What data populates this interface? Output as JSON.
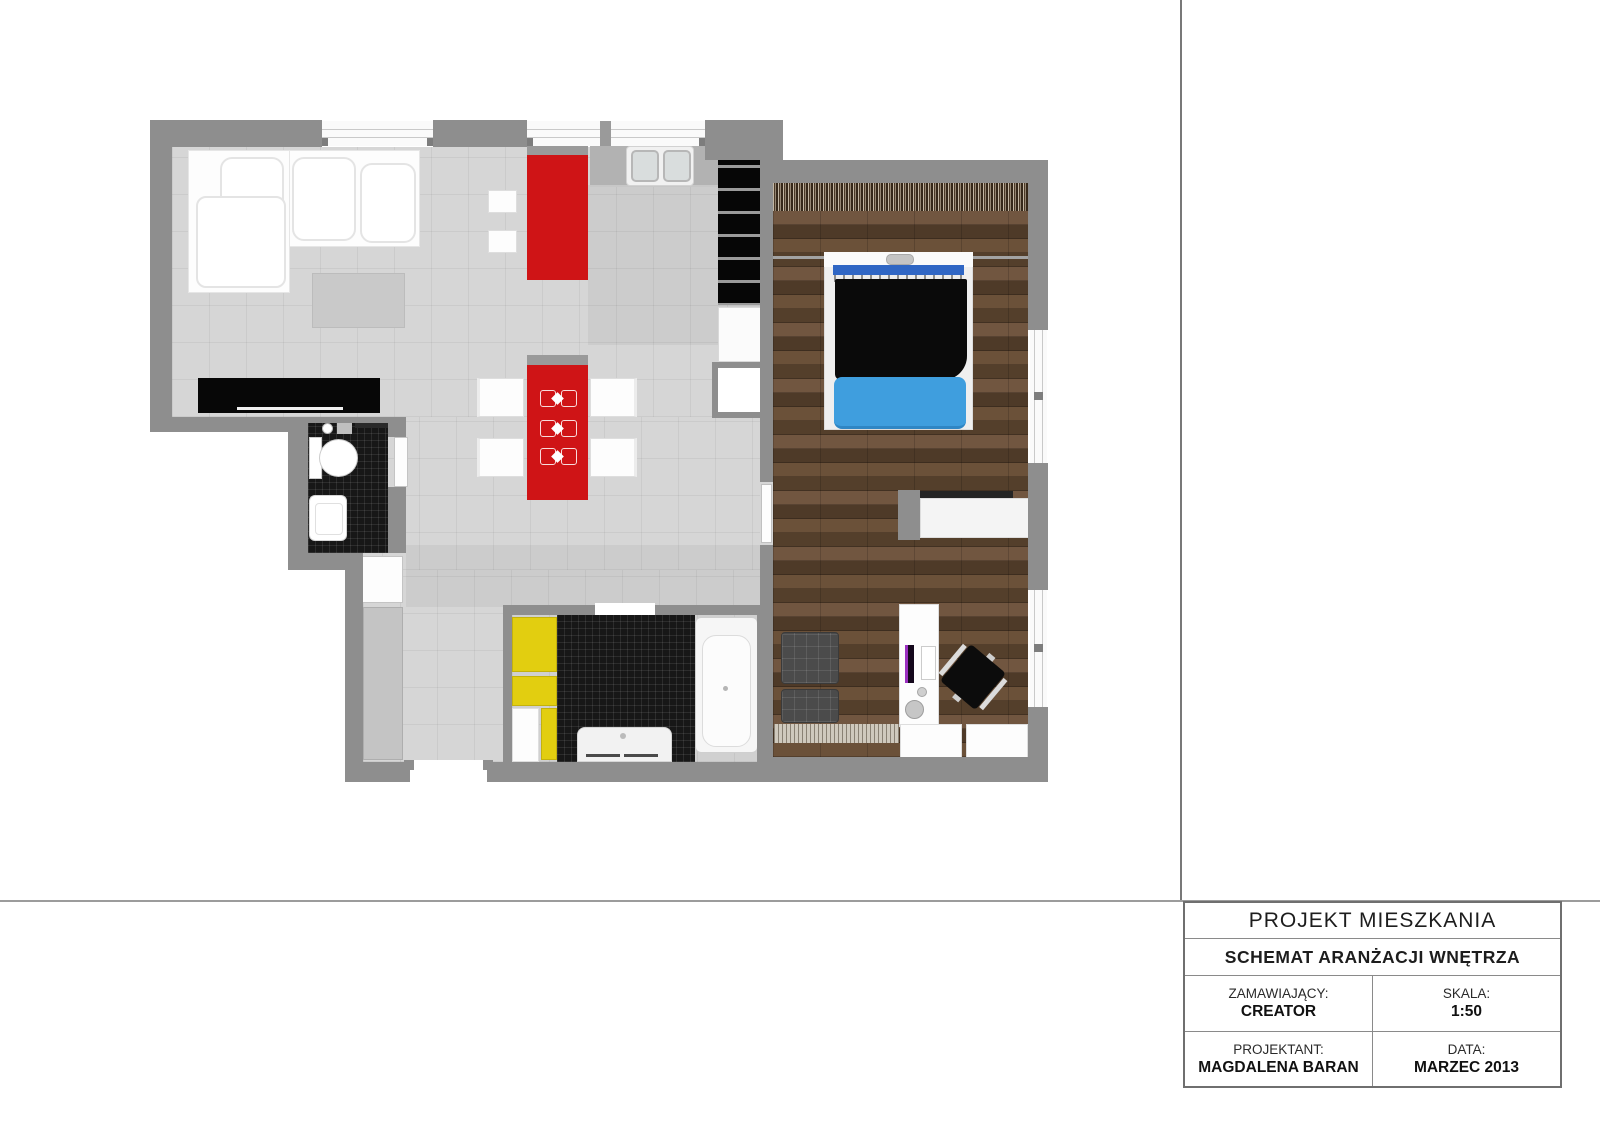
{
  "title_block": {
    "title": "PROJEKT MIESZKANIA",
    "subtitle": "SCHEMAT ARANŻACJI WNĘTRZA",
    "fields": [
      {
        "label": "ZAMAWIAJĄCY:",
        "value": "CREATOR"
      },
      {
        "label": "SKALA:",
        "value": "1:50"
      },
      {
        "label": "PROJEKTANT:",
        "value": "MAGDALENA BARAN"
      },
      {
        "label": "DATA:",
        "value": "MARZEC 2013"
      }
    ]
  },
  "palette": {
    "wall_gray": "#8e8e8e",
    "floor_gray": "#d6d6d6",
    "accent_red": "#cf1416",
    "accent_yellow": "#e2ce10",
    "bed_blanket_blue": "#3f9ede",
    "headboard_blue": "#2f66c4",
    "wood_brown": "#5a442f",
    "tile_black": "#171717"
  }
}
